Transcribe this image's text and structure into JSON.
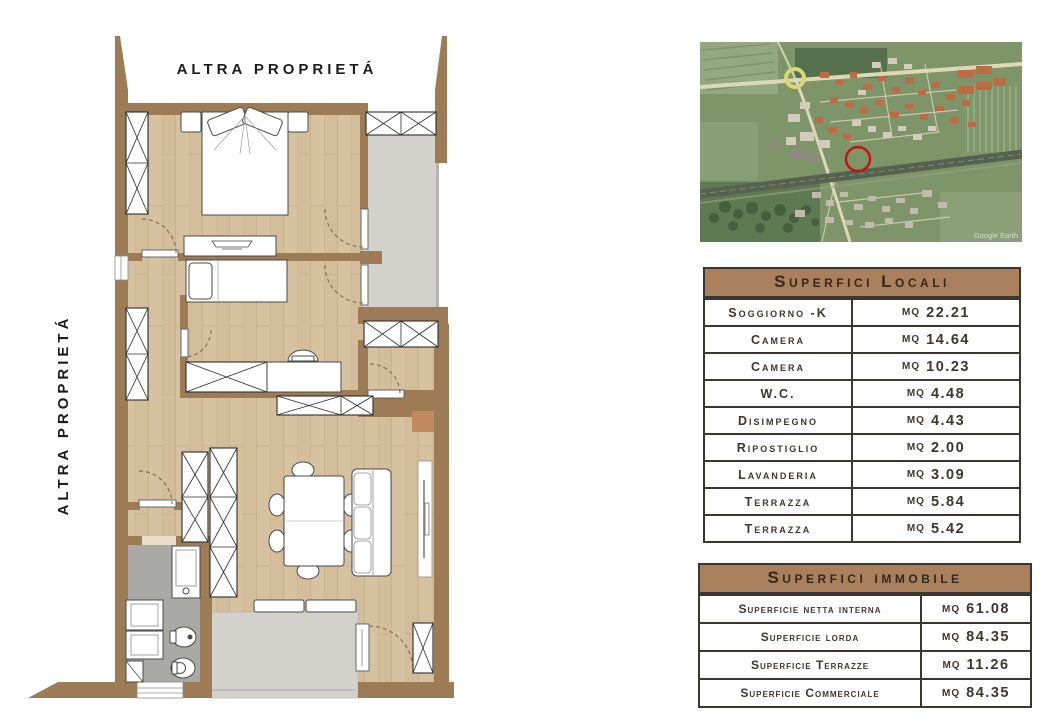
{
  "floor_plan": {
    "top_label": "ALTRA PROPRIETÁ",
    "left_label": "ALTRA PROPRIETÁ",
    "colors": {
      "wall": "#9c7b55",
      "pillar": "#c18a5c",
      "floor": "#d6c1a0",
      "terrace_floor": "#d2d1cc",
      "bathroom_floor": "#a9a9a5"
    }
  },
  "site_map": {
    "watermark": "Google Earth",
    "marker": "red-circle-location-marker",
    "marker_color": "#cc1111"
  },
  "tables": {
    "locali": {
      "title": "Superfici Locali",
      "rows": [
        {
          "label": "Soggiorno -K",
          "unit": "MQ",
          "value": "22.21"
        },
        {
          "label": "Camera",
          "unit": "MQ",
          "value": "14.64"
        },
        {
          "label": "Camera",
          "unit": "MQ",
          "value": "10.23"
        },
        {
          "label": "W.C.",
          "unit": "MQ",
          "value": "4.48"
        },
        {
          "label": "Disimpegno",
          "unit": "MQ",
          "value": "4.43"
        },
        {
          "label": "Ripostiglio",
          "unit": "MQ",
          "value": "2.00"
        },
        {
          "label": "Lavanderia",
          "unit": "MQ",
          "value": "3.09"
        },
        {
          "label": "Terrazza",
          "unit": "MQ",
          "value": "5.84"
        },
        {
          "label": "Terrazza",
          "unit": "MQ",
          "value": "5.42"
        }
      ]
    },
    "immobile": {
      "title": "Superfici immobile",
      "rows": [
        {
          "label": "Superficie netta interna",
          "unit": "MQ",
          "value": "61.08"
        },
        {
          "label": "Superficie lorda",
          "unit": "MQ",
          "value": "84.35"
        },
        {
          "label": "Superficie Terrazze",
          "unit": "MQ",
          "value": "11.26"
        },
        {
          "label": "Superficie Commerciale",
          "unit": "MQ",
          "value": "84.35"
        }
      ]
    }
  }
}
